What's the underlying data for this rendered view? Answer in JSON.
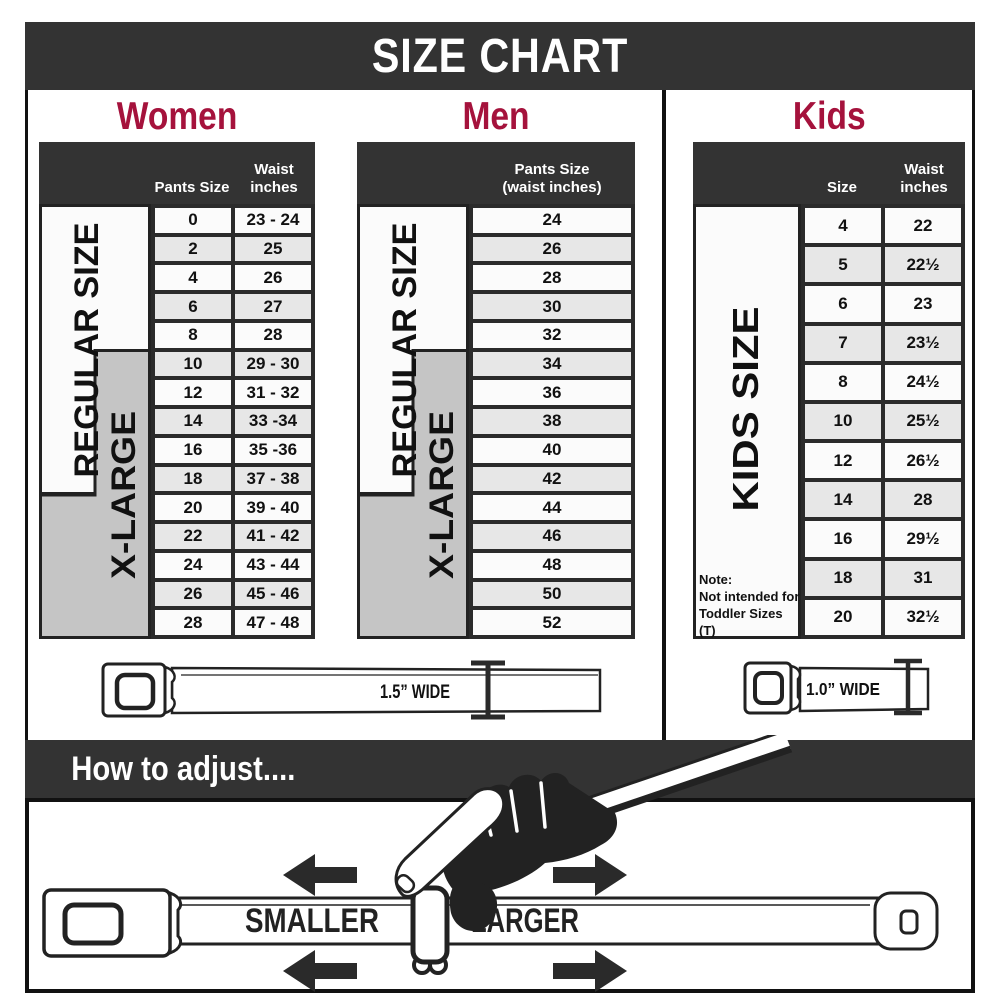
{
  "title": "SIZE CHART",
  "colors": {
    "accent": "#A5123C",
    "bar": "#333333",
    "xlarge_gray": "#C5C5C5"
  },
  "women": {
    "heading": "Women",
    "col1_header": "Pants Size",
    "col2_header_line1": "Waist",
    "col2_header_line2": "inches",
    "regular_label": "REGULAR SIZE",
    "xlarge_label": "X-LARGE",
    "rows": [
      [
        "0",
        "23 - 24"
      ],
      [
        "2",
        "25"
      ],
      [
        "4",
        "26"
      ],
      [
        "6",
        "27"
      ],
      [
        "8",
        "28"
      ],
      [
        "10",
        "29 - 30"
      ],
      [
        "12",
        "31 - 32"
      ],
      [
        "14",
        "33 -34"
      ],
      [
        "16",
        "35 -36"
      ],
      [
        "18",
        "37 - 38"
      ],
      [
        "20",
        "39 - 40"
      ],
      [
        "22",
        "41 - 42"
      ],
      [
        "24",
        "43 - 44"
      ],
      [
        "26",
        "45 - 46"
      ],
      [
        "28",
        "47 - 48"
      ]
    ]
  },
  "men": {
    "heading": "Men",
    "col_header_line1": "Pants Size",
    "col_header_line2": "(waist inches)",
    "regular_label": "REGULAR SIZE",
    "xlarge_label": "X-LARGE",
    "rows": [
      "24",
      "26",
      "28",
      "30",
      "32",
      "34",
      "36",
      "38",
      "40",
      "42",
      "44",
      "46",
      "48",
      "50",
      "52"
    ]
  },
  "kids": {
    "heading": "Kids",
    "col1_header": "Size",
    "col2_header_line1": "Waist",
    "col2_header_line2": "inches",
    "side_label": "KIDS SIZE",
    "note_line1": "Note:",
    "note_line2": "Not intended for",
    "note_line3": "Toddler Sizes (T)",
    "rows": [
      [
        "4",
        "22"
      ],
      [
        "5",
        "22½"
      ],
      [
        "6",
        "23"
      ],
      [
        "7",
        "23½"
      ],
      [
        "8",
        "24½"
      ],
      [
        "10",
        "25½"
      ],
      [
        "12",
        "26½"
      ],
      [
        "14",
        "28"
      ],
      [
        "16",
        "29½"
      ],
      [
        "18",
        "31"
      ],
      [
        "20",
        "32½"
      ]
    ]
  },
  "belts": {
    "women_men_width_label": "1.5” WIDE",
    "kids_width_label": "1.0” WIDE"
  },
  "adjust": {
    "heading": "How to adjust....",
    "smaller_label": "SMALLER",
    "larger_label": "LARGER"
  }
}
